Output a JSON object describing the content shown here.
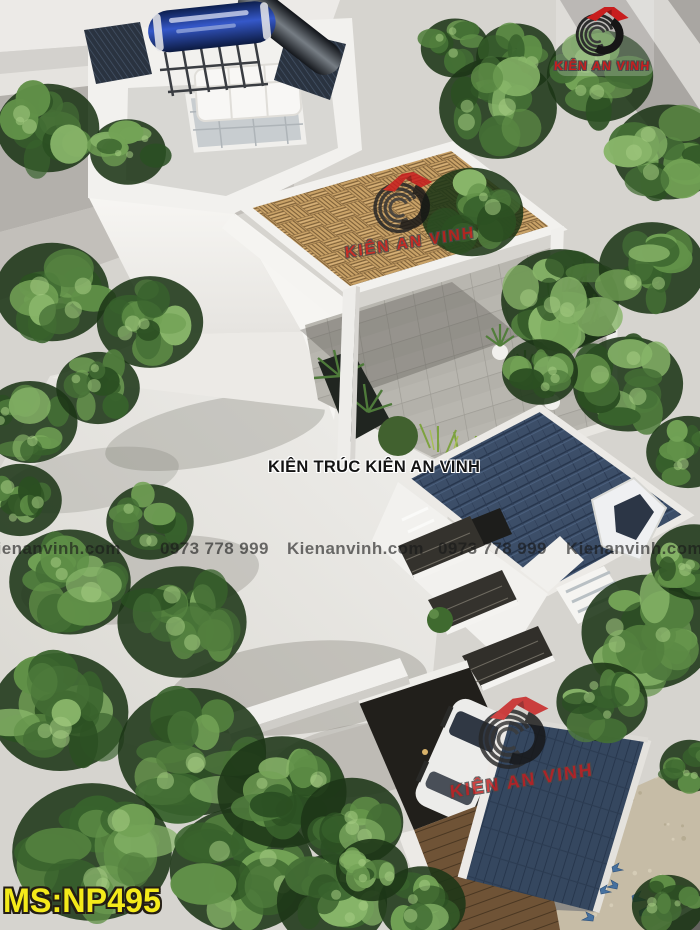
{
  "brand": {
    "name": "KIÊN AN VINH"
  },
  "watermarks": {
    "center_title": "KIÊN TRÚC KIÊN AN VINH",
    "bottom_row": [
      "Kienanvinh.com",
      "0973 778 999",
      "Kienanvinh.com",
      "0973 778 999",
      "Kienanvinh.com"
    ],
    "code": "MS:NP495"
  },
  "colors": {
    "brand_red": "#c81e1e",
    "logo_dark": "#3b3b3b",
    "code_yellow": "#f4ea1a",
    "roof_blue": "#3c4e68",
    "roof_blue_dark": "#27364d",
    "wood": "#c9a267",
    "leaf_green": "#4c7e3d",
    "wall_white": "#f3f2ef",
    "ground": "#d6d4cf",
    "pavement_tan": "#c6bca6"
  }
}
